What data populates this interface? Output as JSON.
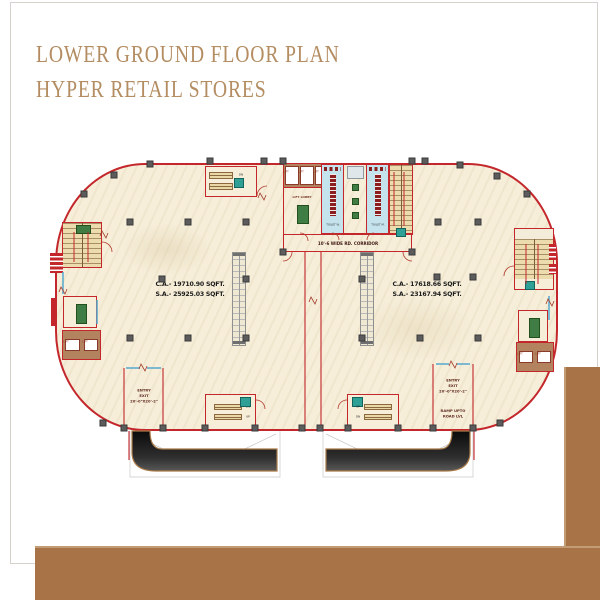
{
  "title": {
    "line1": "LOWER GROUND FLOOR PLAN",
    "line2": "HYPER RETAIL STORES"
  },
  "units": {
    "left": {
      "ca": "C.A.- 19710.90 SQFT.",
      "sa": "S.A.- 25925.03 SQFT."
    },
    "right": {
      "ca": "C.A.- 17618.66 SQFT.",
      "sa": "S.A.- 23167.94 SQFT."
    }
  },
  "labels": {
    "corridor": "10'-6 WIDE RD. CORRIDOR",
    "lift_lobby": "LIFT LOBBY",
    "lift": "LIFT",
    "toilet_w": "TOILET W.",
    "toilet_m": "TOILET M.",
    "entry1": "ENTRY",
    "entry2": "EXIT",
    "entry3": "20'-0\"X20'-2\"",
    "ramp1": "RAMP UPTO",
    "ramp2": "ROAD LVL",
    "up": "UP",
    "dn": "DN"
  },
  "colors": {
    "frame_brown": "#a87346",
    "title_tan": "#b48d62",
    "wall_red": "#c3272b",
    "floor_cream": "#f6eed9",
    "toilet_blue": "#c5e3ed",
    "stair_tan": "#ecdcad",
    "lift_brown": "#b3825f",
    "rug_green": "#3f7d44",
    "sign_teal": "#2fa096",
    "ramp_dark": "#161616"
  }
}
